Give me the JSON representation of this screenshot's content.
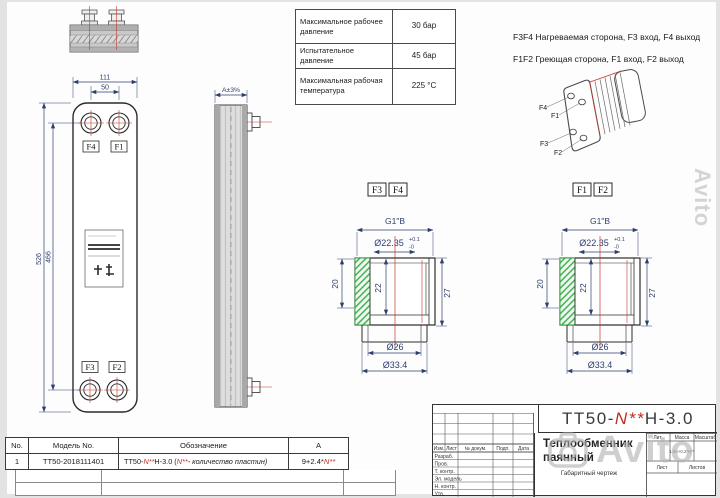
{
  "watermark": {
    "brand": "Avito"
  },
  "spec_table": {
    "rows": [
      {
        "label": "Максимальное рабочее давление",
        "value": "30 бар"
      },
      {
        "label": "Испытательное давление",
        "value": "45 бар"
      },
      {
        "label": "Максимальная рабочая температура",
        "value": "225 °C"
      }
    ]
  },
  "notes": {
    "line1": "F3F4 Нагреваемая сторона, F3 вход, F4 выход",
    "line2": "F1F2 Греющая сторона, F1 вход, F2 выход"
  },
  "iso_view": {
    "f4": "F4",
    "f1": "F1",
    "f3": "F3",
    "f2": "F2"
  },
  "front_view": {
    "dim_width": "111",
    "dim_port_width": "50",
    "dim_height": "526",
    "dim_port_height": "466",
    "port_tl": "F4",
    "port_tr": "F1",
    "port_bl": "F3",
    "port_br": "F2"
  },
  "side_view": {
    "dim_thickness": "A±3%"
  },
  "detail_f3f4": {
    "tag1": "F3",
    "tag2": "F4",
    "thread": "G1\"B",
    "bore": "Ø22.35",
    "tol_up": "+0.1",
    "tol_dn": "-0",
    "depth1": "20",
    "depth2": "22",
    "height": "27",
    "dia_inner": "Ø26",
    "dia_outer": "Ø33.4"
  },
  "detail_f1f2": {
    "tag1": "F1",
    "tag2": "F2",
    "thread": "G1\"B",
    "bore": "Ø22.35",
    "tol_up": "+0.1",
    "tol_dn": "-0",
    "depth1": "20",
    "depth2": "22",
    "height": "27",
    "dia_inner": "Ø26",
    "dia_outer": "Ø33.4"
  },
  "parts_table": {
    "headers": {
      "no": "No.",
      "model": "Модель No.",
      "designation": "Обозначение",
      "a": "A"
    },
    "row": {
      "no": "1",
      "model": "ТТ50-2018111401",
      "desig_p1": "ТТ50-",
      "desig_n1": "N**",
      "desig_p2": "H-3.0  (",
      "desig_n2": "N**",
      "desig_p3": "- количество пластин)",
      "a_p1": "9+2.4*",
      "a_n": "N**"
    }
  },
  "title_block": {
    "num_p1": "ТТ50-",
    "num_n": "N**",
    "num_p2": "H-3.0",
    "product1": "Теплообменник",
    "product2": "паянный",
    "doc_type": "Габаритный чертеж",
    "cols": {
      "izm": "Изм.",
      "list": "Лист",
      "doc": "№ докум.",
      "podp": "Подп.",
      "data": "Дата"
    },
    "rows": [
      "Разраб.",
      "Пров.",
      "Т. контр.",
      "Эл. модель",
      "Н. контр.",
      "Утв."
    ],
    "lit": "Лит.",
    "mass": "Масса",
    "scale": "Масштаб",
    "mass_value": "1.84+0.2*N**",
    "sheet": "Лист",
    "sheets": "Листов"
  }
}
